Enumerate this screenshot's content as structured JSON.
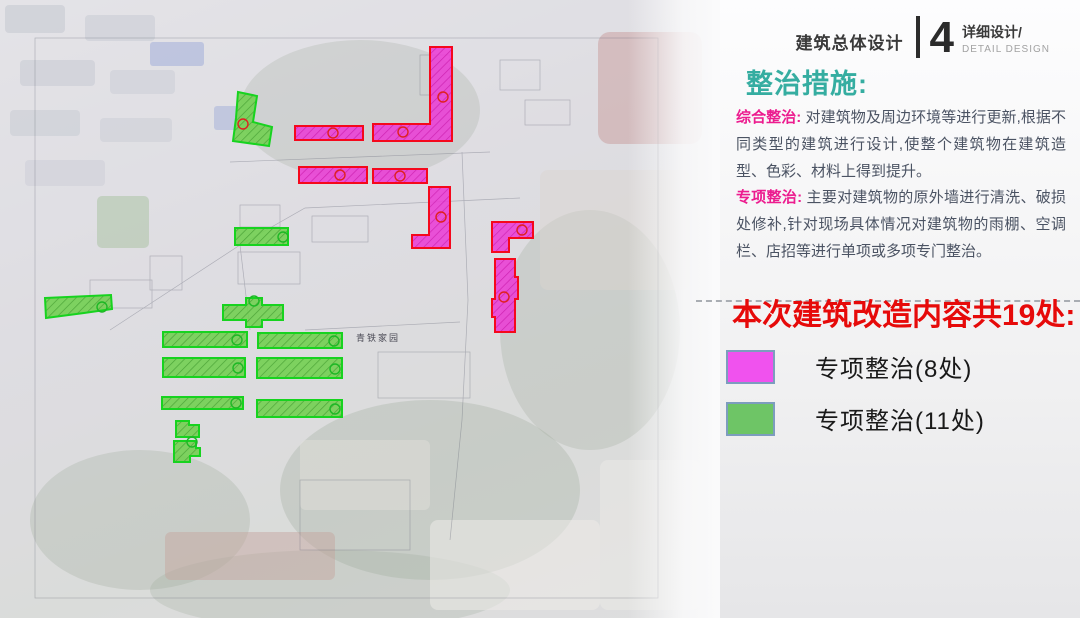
{
  "header": {
    "title": "建筑总体设计",
    "number": "4",
    "subtitle": "详细设计/",
    "subtitle_en": "DETAIL DESIGN"
  },
  "panel": {
    "section_title": "整治措施:",
    "paragraphs": [
      {
        "lead": "综合整治:",
        "text": " 对建筑物及周边环境等进行更新,根据不同类型的建筑进行设计,使整个建筑物在建筑造型、色彩、材料上得到提升。"
      },
      {
        "lead": "专项整治:",
        "text": " 主要对建筑物的原外墙进行清洗、破损处修补,针对现场具体情况对建筑物的雨棚、空调栏、店招等进行单项或多项专门整治。"
      }
    ],
    "highlight_title": "本次建筑改造内容共19处:",
    "legend": [
      {
        "label": "专项整治(8处)",
        "color": "#f052ee"
      },
      {
        "label": "专项整治(11处)",
        "color": "#6ec566"
      }
    ]
  },
  "map": {
    "label": "青铁家园",
    "colors": {
      "magenta_fill": "#ea3cd5",
      "magenta_stroke": "#f5081c",
      "green_fill": "#70cf4d",
      "green_stroke": "#17d31f",
      "marker_red": "#e02020",
      "marker_green": "#1db825"
    },
    "shapes": [
      {
        "type": "magenta",
        "points": "430,47 452,47 452,141 373,141 373,124 430,124"
      },
      {
        "type": "magenta",
        "points": "295,126 363,126 363,140 295,140"
      },
      {
        "type": "magenta",
        "points": "299,167 367,167 367,183 299,183"
      },
      {
        "type": "magenta",
        "points": "373,169 427,169 427,183 373,183"
      },
      {
        "type": "magenta",
        "points": "429,187 450,187 450,248 412,248 412,235 429,235"
      },
      {
        "type": "magenta",
        "points": "492,222 533,222 533,238 509,238 509,252 492,252"
      },
      {
        "type": "magenta",
        "points": "495,259 515,259 515,277 518,277 518,299 515,299 515,332 495,332 495,317 492,317 492,299 495,299"
      },
      {
        "type": "green",
        "points": "238,92 257,96 253,122 272,127 269,146 233,141 236,118"
      },
      {
        "type": "green",
        "points": "235,228 288,228 288,245 235,245"
      },
      {
        "type": "green",
        "points": "45,298 111,295 112,309 84,313 46,318"
      },
      {
        "type": "green",
        "points": "246,298 262,298 262,305 283,305 283,320 262,320 262,327 246,327 246,320 223,320 223,305 246,305"
      },
      {
        "type": "green",
        "points": "163,332 247,332 247,347 163,347"
      },
      {
        "type": "green",
        "points": "258,333 342,333 342,348 258,348"
      },
      {
        "type": "green",
        "points": "163,358 245,358 245,377 163,377"
      },
      {
        "type": "green",
        "points": "257,358 342,358 342,378 257,378"
      },
      {
        "type": "green",
        "points": "162,397 243,397 243,409 162,409"
      },
      {
        "type": "green",
        "points": "257,400 342,400 342,417 257,417"
      },
      {
        "type": "green",
        "points": "176,421 189,421 189,425 199,425 199,437 176,437"
      },
      {
        "type": "green",
        "points": "174,441 196,441 196,448 200,448 200,456 190,456 190,462 174,462"
      }
    ],
    "markers": [
      {
        "x": 333,
        "y": 133,
        "c": "red"
      },
      {
        "x": 403,
        "y": 132,
        "c": "red"
      },
      {
        "x": 443,
        "y": 97,
        "c": "red"
      },
      {
        "x": 340,
        "y": 175,
        "c": "red"
      },
      {
        "x": 400,
        "y": 176,
        "c": "red"
      },
      {
        "x": 441,
        "y": 217,
        "c": "red"
      },
      {
        "x": 522,
        "y": 230,
        "c": "red"
      },
      {
        "x": 504,
        "y": 297,
        "c": "red"
      },
      {
        "x": 243,
        "y": 124,
        "c": "red"
      },
      {
        "x": 283,
        "y": 237,
        "c": "green"
      },
      {
        "x": 102,
        "y": 307,
        "c": "green"
      },
      {
        "x": 254,
        "y": 301,
        "c": "green"
      },
      {
        "x": 237,
        "y": 340,
        "c": "green"
      },
      {
        "x": 334,
        "y": 341,
        "c": "green"
      },
      {
        "x": 238,
        "y": 368,
        "c": "green"
      },
      {
        "x": 335,
        "y": 369,
        "c": "green"
      },
      {
        "x": 236,
        "y": 403,
        "c": "green"
      },
      {
        "x": 335,
        "y": 409,
        "c": "green"
      },
      {
        "x": 192,
        "y": 442,
        "c": "green"
      }
    ]
  }
}
